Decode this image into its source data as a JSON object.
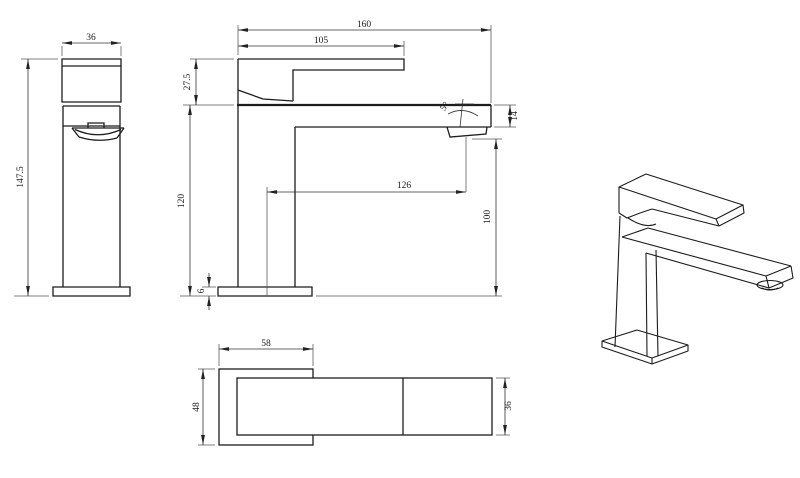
{
  "drawing": {
    "kind": "faucet-technical-drawing",
    "line_color": "#1c1c1c",
    "dim_color": "#333333",
    "background": "#ffffff",
    "views": {
      "side": {
        "width": "36",
        "height": "147.5"
      },
      "front": {
        "overall_reach": "160",
        "handle_reach": "105",
        "handle_height": "27.5",
        "spout_angle": "5°",
        "spout_thickness": "14",
        "spout_center_reach": "126",
        "body_height": "120",
        "outlet_height": "100",
        "base_thickness": "6"
      },
      "top": {
        "base_width": "58",
        "base_depth": "48",
        "spout_width": "36"
      }
    }
  }
}
